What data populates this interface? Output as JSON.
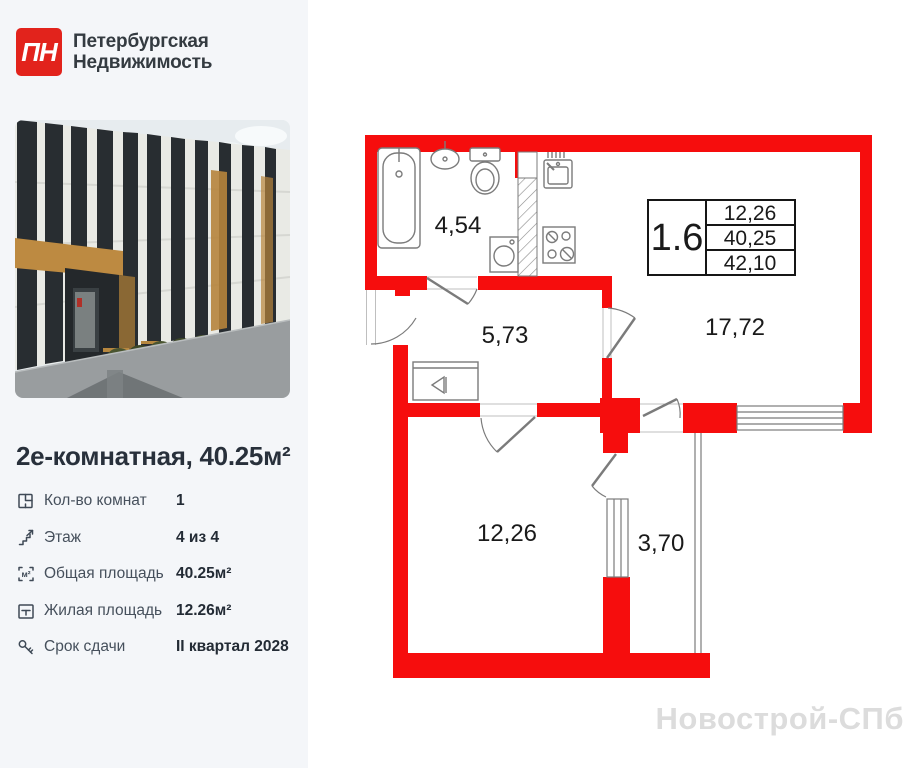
{
  "brand": {
    "monogram": "ПН",
    "name_line1": "Петербургская",
    "name_line2": "Недвижимость"
  },
  "listing": {
    "title": "2е-комнатная, 40.25м²",
    "details": [
      {
        "icon": "rooms-count-icon",
        "label": "Кол-во комнат",
        "value": "1"
      },
      {
        "icon": "floor-stairs-icon",
        "label": "Этаж",
        "value": "4 из 4"
      },
      {
        "icon": "total-area-icon",
        "label": "Общая площадь",
        "value": "40.25м²"
      },
      {
        "icon": "living-area-icon",
        "label": "Жилая площадь",
        "value": "12.26м²"
      },
      {
        "icon": "key-icon",
        "label": "Срок сдачи",
        "value": "II квартал 2028"
      }
    ]
  },
  "plan": {
    "unit_code": "1.6",
    "unit_table_rows": [
      "12,26",
      "40,25",
      "42,10"
    ],
    "areas": {
      "bathroom": "4,54",
      "hallway": "5,73",
      "kitchen_living": "17,72",
      "bedroom": "12,26",
      "balcony": "3,70"
    }
  },
  "watermark": "Новострой-СПб",
  "colors": {
    "wall_red": "#f60d0d",
    "logo_red": "#e2231c",
    "plan_line_gray": "#7b7b7b"
  }
}
